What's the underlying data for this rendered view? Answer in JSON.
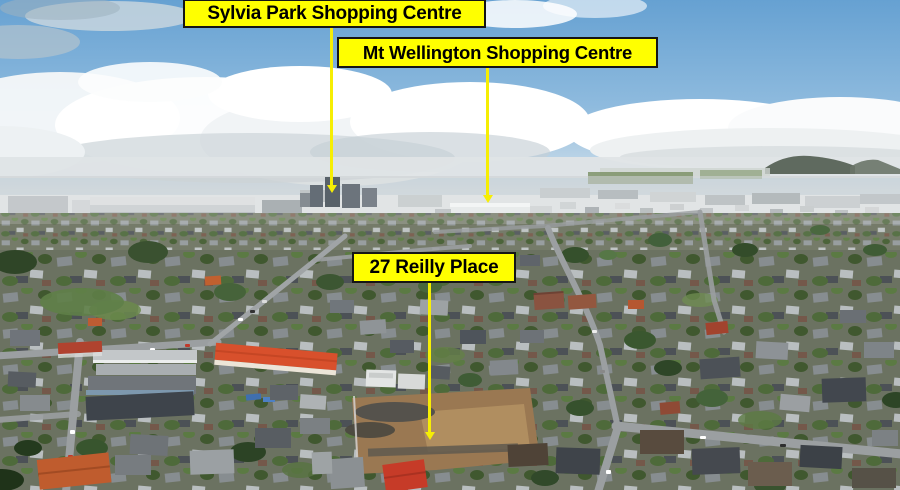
{
  "callouts": [
    {
      "id": "sylvia-park",
      "text": "Sylvia Park Shopping Centre"
    },
    {
      "id": "mt-wellington",
      "text": "Mt Wellington Shopping Centre"
    },
    {
      "id": "reilly-place",
      "text": "27 Reilly Place"
    }
  ],
  "colors": {
    "callout_background": "#FFFF00",
    "callout_border": "#151515",
    "callout_text": "#000000",
    "pointer_line": "#F6EE04",
    "sky_blue": "#6BA3D3",
    "red_roof_building": "#D8502C"
  }
}
